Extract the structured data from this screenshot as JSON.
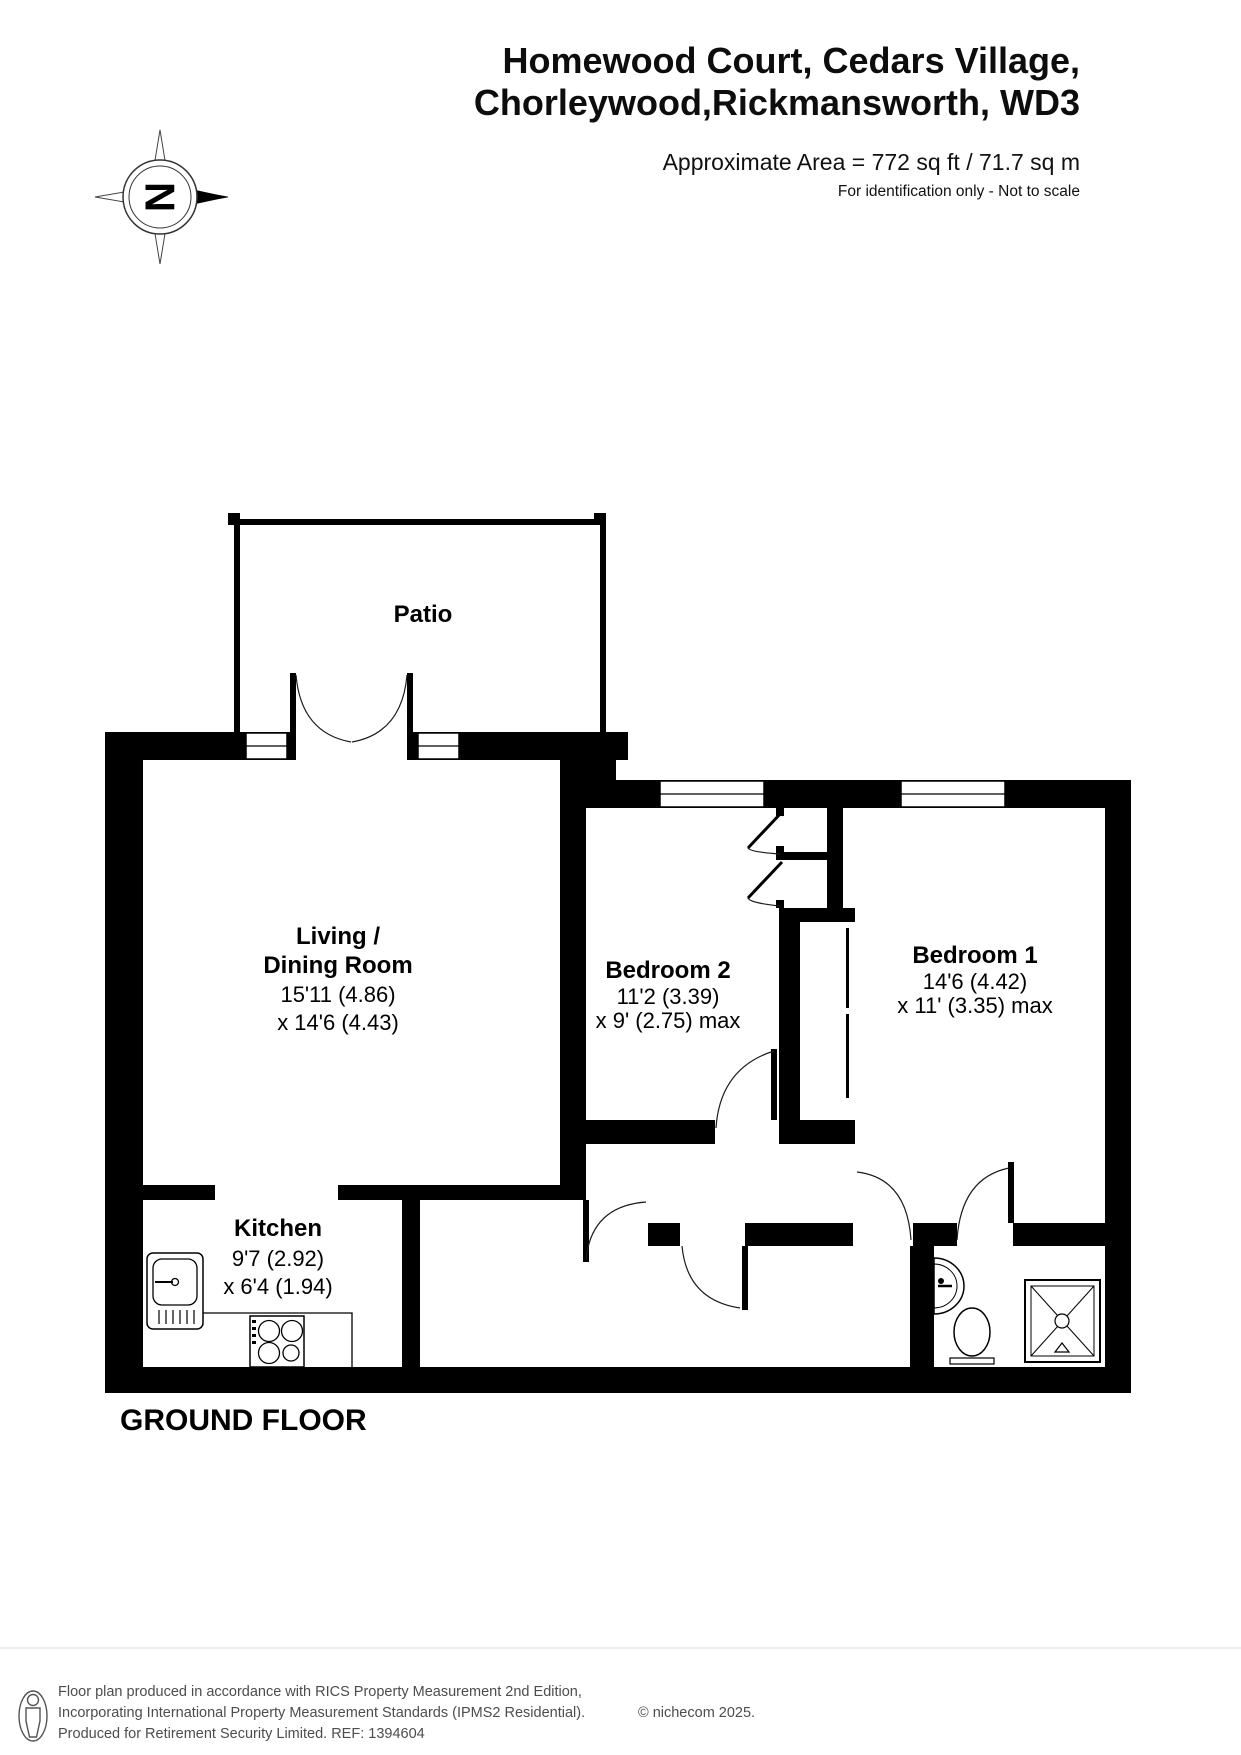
{
  "header": {
    "title_line1": "Homewood Court, Cedars Village,",
    "title_line2": "Chorleywood,Rickmansworth, WD3",
    "area_text": "Approximate Area = 772 sq ft / 71.7 sq m",
    "disclaimer": "For identification only - Not to scale"
  },
  "compass": {
    "letter": "N"
  },
  "floor_label": "GROUND FLOOR",
  "rooms": {
    "patio": {
      "name": "Patio"
    },
    "living": {
      "name_line1": "Living /",
      "name_line2": "Dining Room",
      "dim_line1": "15'11 (4.86)",
      "dim_line2": "x 14'6 (4.43)"
    },
    "bedroom2": {
      "name": "Bedroom 2",
      "dim_line1": "11'2 (3.39)",
      "dim_line2": "x 9' (2.75) max"
    },
    "bedroom1": {
      "name": "Bedroom 1",
      "dim_line1": "14'6 (4.42)",
      "dim_line2": "x 11' (3.35) max"
    },
    "kitchen": {
      "name": "Kitchen",
      "dim_line1": "9'7 (2.92)",
      "dim_line2": "x 6'4 (1.94)"
    }
  },
  "footer": {
    "line1": "Floor plan produced in accordance with RICS Property Measurement 2nd Edition,",
    "line2": "Incorporating International Property Measurement Standards (IPMS2 Residential).",
    "line2b": "© nichecom 2025.",
    "line3": "Produced for Retirement Security Limited.   REF: 1394604"
  },
  "colors": {
    "wall": "#000000",
    "footer_text": "#4d4d4d",
    "background": "#ffffff"
  }
}
